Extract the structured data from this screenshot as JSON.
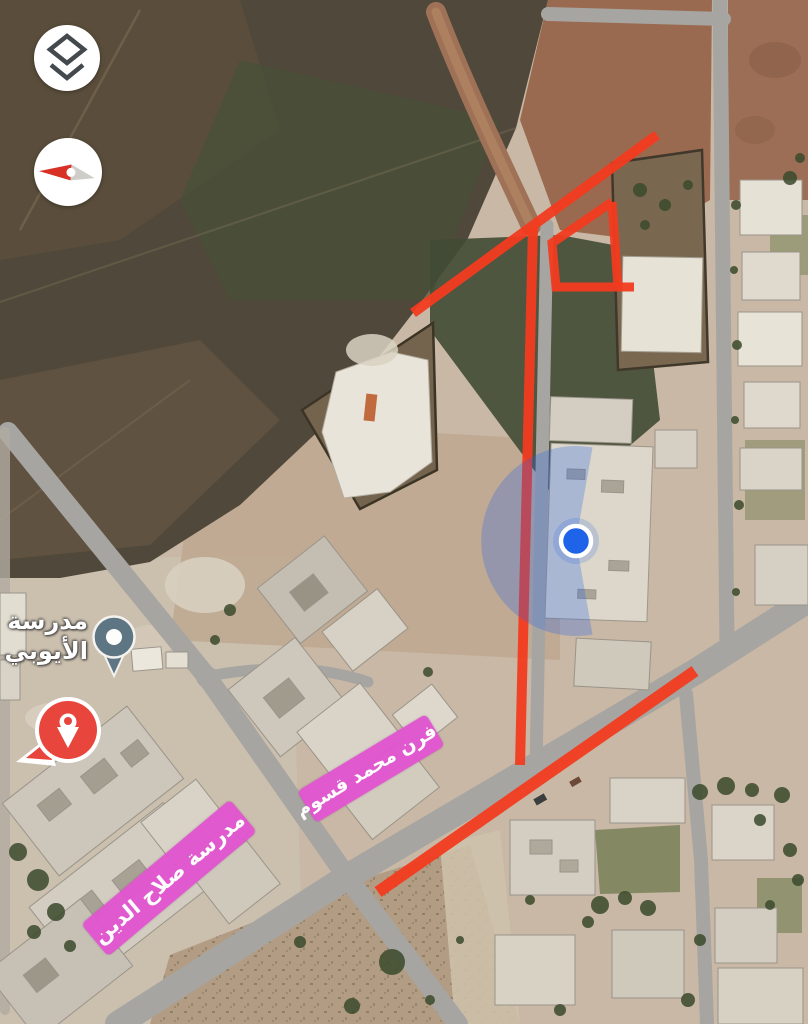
{
  "view": {
    "mode": "satellite"
  },
  "controls": {
    "layers_button": {
      "icon": "layers-icon"
    },
    "compass_button": {
      "icon": "compass-needle-icon"
    }
  },
  "markers": {
    "school_poi": {
      "label_line1": "مدرسة",
      "label_line2": "الأيوبي",
      "pin_color": "#5e7684"
    },
    "place_marker": {
      "color": "#e8453c"
    },
    "my_location": {
      "color": "#1e63e8"
    }
  },
  "annotations": {
    "route_color": "#f23b1f",
    "highlight_color": "#e156d0",
    "labels": [
      {
        "text": "فرن محمد قسوم"
      },
      {
        "text": "مدرسة صلاح الدين"
      }
    ]
  }
}
